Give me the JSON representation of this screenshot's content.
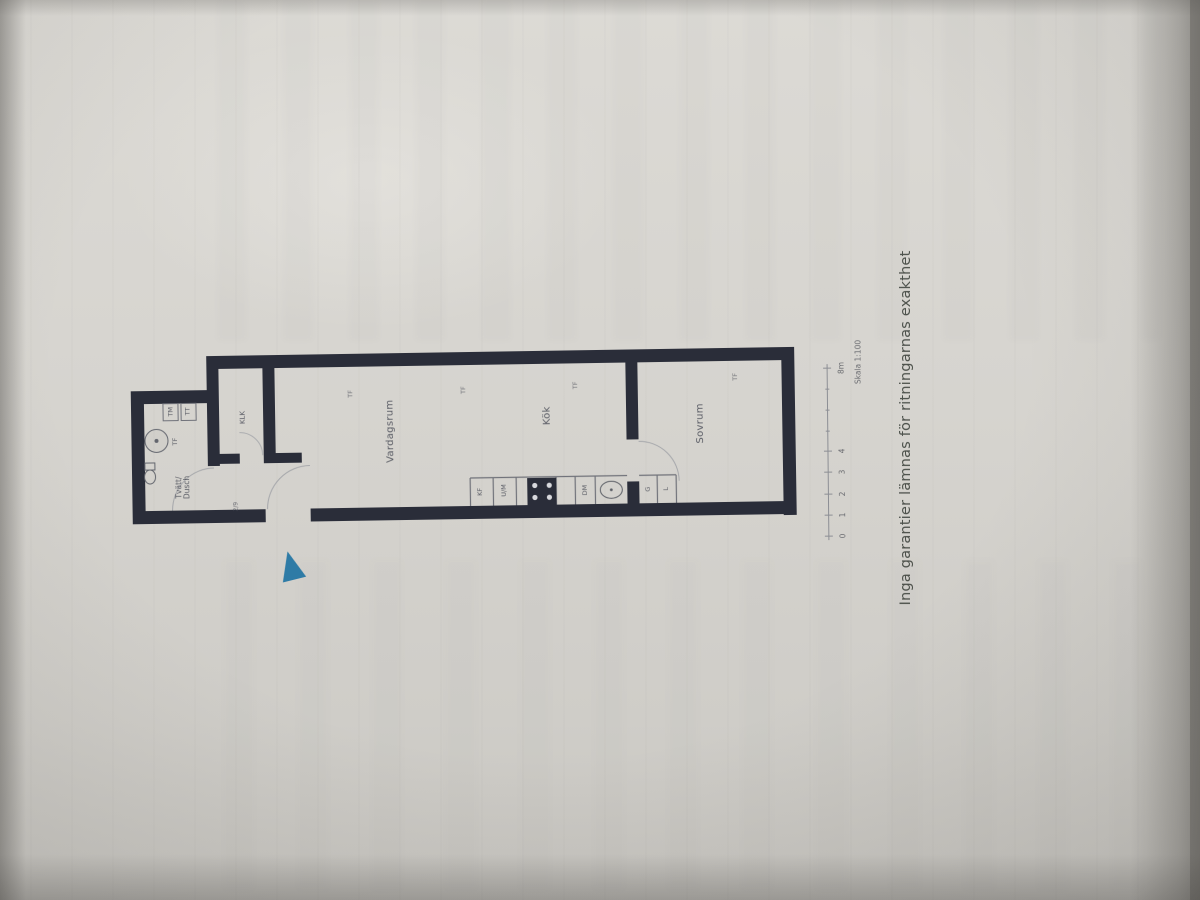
{
  "plan": {
    "rooms": {
      "bathroom_line1": "Tvätt/",
      "bathroom_line2": "Dusch",
      "closet": "KLK",
      "living": "Vardagsrum",
      "kitchen": "Kök",
      "bedroom": "Sovrum"
    },
    "fixtures": {
      "washing_machine": "TM",
      "dryer": "TT",
      "bath_cabinet": "TF",
      "fridge_freezer": "KF",
      "oven_micro": "U/M",
      "dishwasher": "DM",
      "wardrobe": "G",
      "linen_closet": "L"
    },
    "window_marker": "TF",
    "entry_note": "2/9"
  },
  "scale_bar": {
    "label": "Skala 1:100",
    "ticks": [
      "0",
      "1",
      "2",
      "3",
      "4",
      "8m"
    ]
  },
  "disclaimer": "Inga garantier lämnas för ritningarnas exakthet",
  "colors": {
    "wall": "#2a2d39",
    "arrow": "#2e7ba6",
    "label": "#454853",
    "caption": "#3e433d"
  }
}
